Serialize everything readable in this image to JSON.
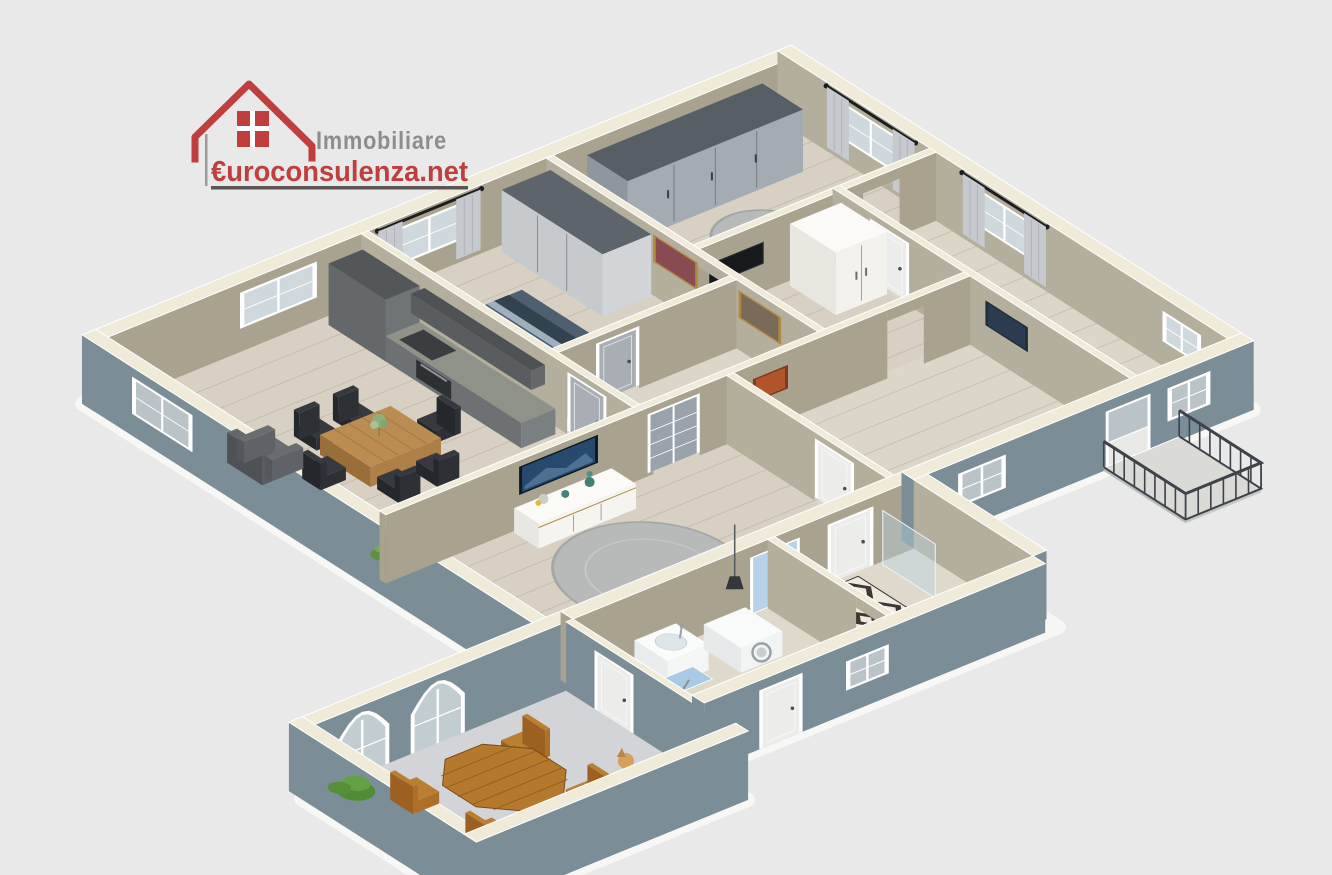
{
  "logo": {
    "line1": "Immobiliare",
    "line2": "€uroconsulenza.net",
    "red": "#bf3e3e",
    "gray": "#8d8d8d",
    "underline": "#5c5353"
  },
  "palette": {
    "background": "#e9e9e9",
    "halo": "#f7f7f5",
    "wall_exterior": "#7b8e98",
    "wall_exterior_dark": "#74868f",
    "wall_top": "#f0ebd9",
    "wall_interior": "#a8a28f",
    "wall_interior_light": "#b4ae9c",
    "floor_wood": "#d7d0c3",
    "floor_pale": "#dcd6c9",
    "floor_wing": "#ded9cb",
    "terrace_floor": "#d3d4d8",
    "plank_line": "#b3a78f",
    "window_frame": "#ffffff",
    "window_glass": "#cfd8dc",
    "glass_exterior": "#b9c3c8",
    "curtain": "#c6c9ce",
    "rod": "#1d1d1f",
    "door_gray": "#a9aeb5",
    "door_white": "#ececea",
    "door_glass": "#9aa2ac",
    "glass_blue": "#b8d3e9",
    "wardrobe_gray_light": "#c7cacd",
    "rug_gray": "#b7bab8",
    "rug_dark": "#3b3733",
    "rug_light": "#efe9df",
    "appliance_dark": "#2e3134",
    "blanket": "#4e5f70",
    "blanket_dark": "#33424f",
    "gold": "#b08a3e",
    "art_blue": "#27496e",
    "art_orange": "#b2552b",
    "art_dark": "#2c3c50",
    "art_red": "#8a4a52",
    "patio_wood": "#b5792e",
    "dog": "#d4a15d",
    "railing": "#3e434a",
    "balcony_floor": "#dadbd7"
  },
  "scene_elements": [
    "dining-room",
    "kitchen",
    "dining-table",
    "armchair",
    "bedroom-1",
    "bed",
    "wardrobe",
    "bedroom-2",
    "hallway",
    "living-room",
    "sideboard",
    "wall-art",
    "bathroom",
    "patterned-rug",
    "shower-glass",
    "laundry-room",
    "corner-sink",
    "washing-machine",
    "ironing-board",
    "terrace",
    "arched-doors",
    "patio-table",
    "patio-chairs",
    "dog",
    "plant",
    "balcony",
    "railing",
    "windows",
    "curtains",
    "doors"
  ]
}
